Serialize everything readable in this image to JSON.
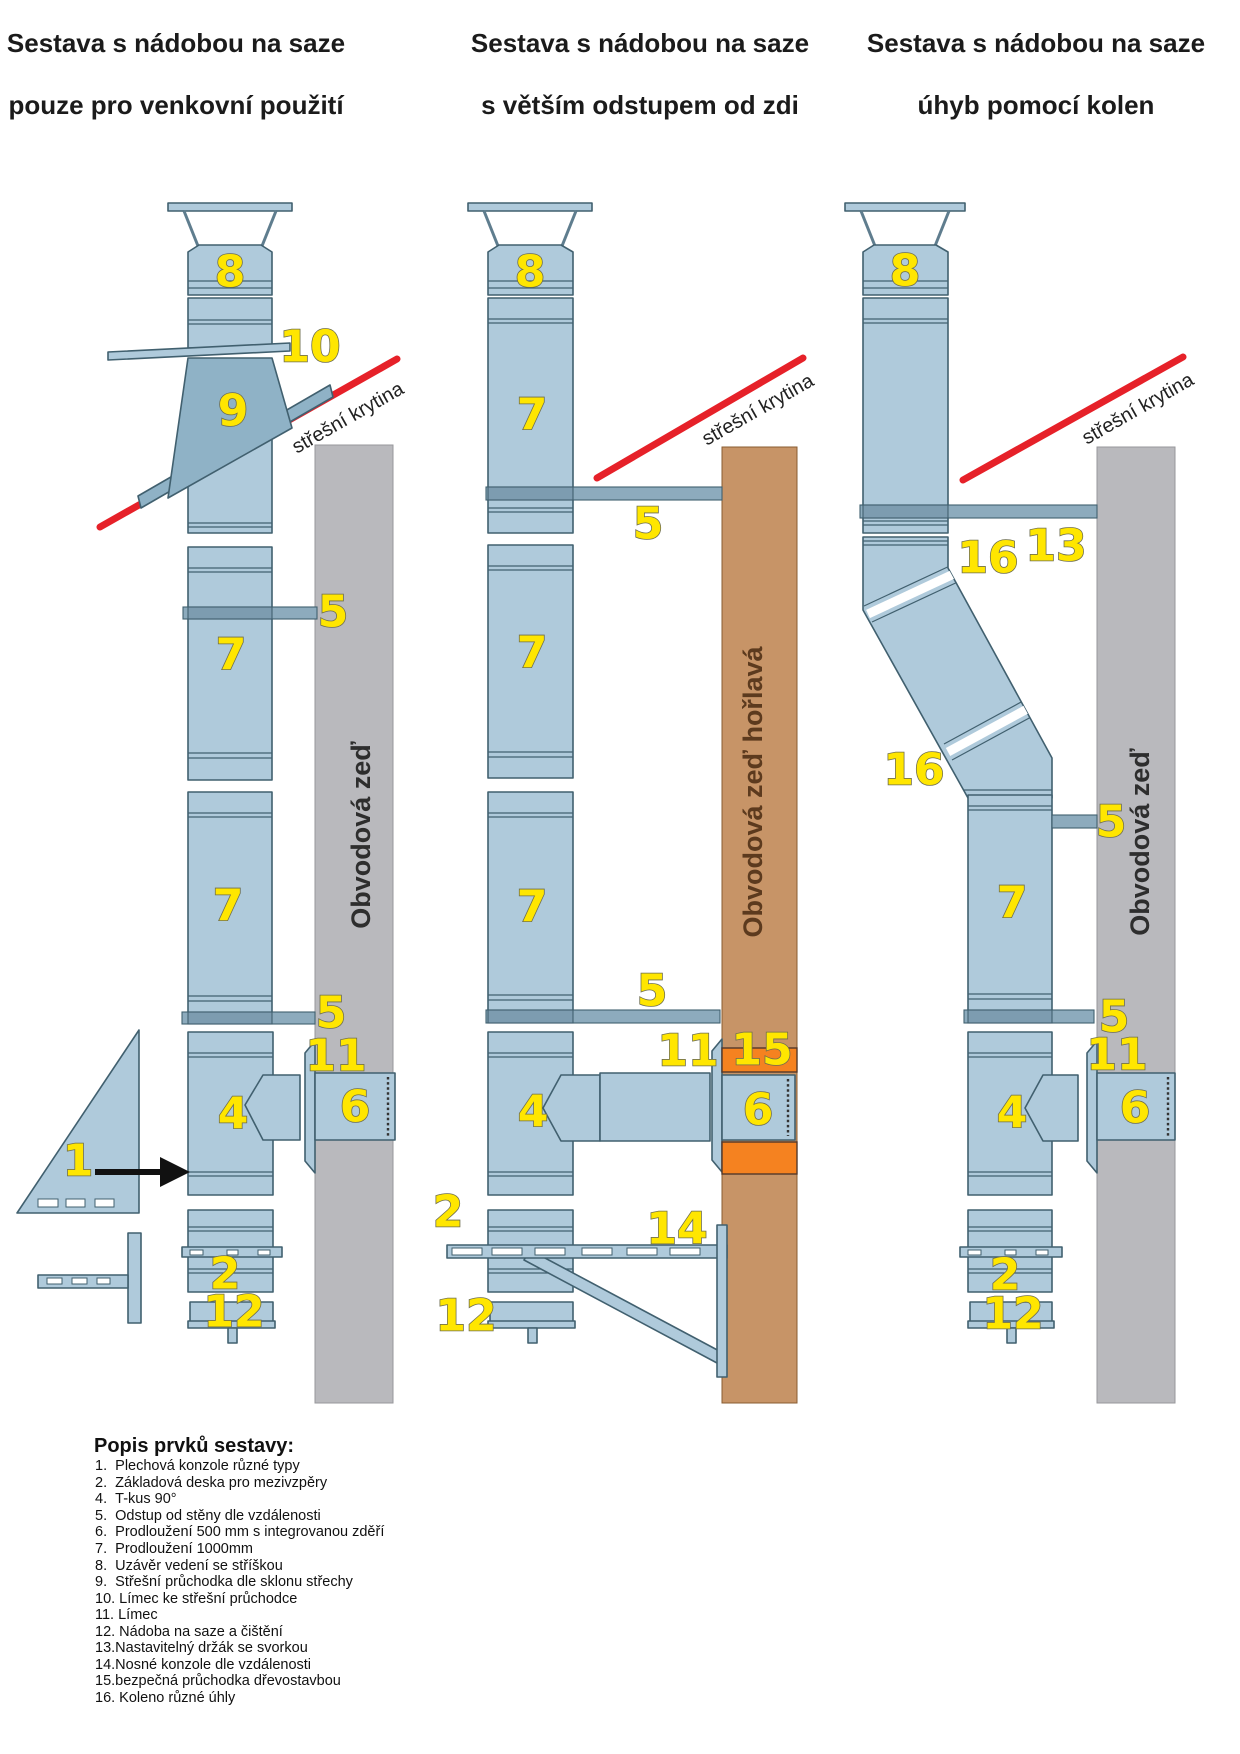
{
  "colors": {
    "pipe": "#afcadb",
    "pipe_stroke": "#41606f",
    "flash": "#8fb2c6",
    "bar": "#8dabbd",
    "bar_dark": "#7d9cb0",
    "wall_gray": "#b9b9bd",
    "wall_gray_stroke": "#97979b",
    "wall_tan": "#c79467",
    "wall_tan_stroke": "#8a5c32",
    "orange": "#f58220",
    "red": "#e62129",
    "yellow": "#ffe600",
    "num_stroke": "#6d6d50",
    "title": "#1b1b1b",
    "roof_text": "#222222",
    "wall_text": "#2e2e2e",
    "wall_text_tan": "#5c3a1e",
    "steel": "#5f7d8e"
  },
  "titles": [
    {
      "line1": "Sestava s nádobou na saze",
      "line2": "pouze pro venkovní použití"
    },
    {
      "line1": "Sestava s nádobou na saze",
      "line2": "s větším odstupem od zdi"
    },
    {
      "line1": "Sestava s nádobou na saze",
      "line2": "úhyb pomocí kolen"
    }
  ],
  "annotations": {
    "roof_covering": "střešní krytina",
    "perimeter_wall": "Obvodová zeď",
    "perimeter_wall_flammable": "Obvodová zeď hořlavá"
  },
  "labels": {
    "l1": "1",
    "l2": "2",
    "l4": "4",
    "l5": "5",
    "l6": "6",
    "l7": "7",
    "l8": "8",
    "l9": "9",
    "l10": "10",
    "l11": "11",
    "l12": "12",
    "l13": "13",
    "l14": "14",
    "l15": "15",
    "l16": "16"
  },
  "legend": {
    "heading": "Popis prvků sestavy:",
    "items": [
      "1.  Plechová konzole různé typy",
      "2.  Základová deska pro mezivzpěry",
      "4.  T-kus 90°",
      "5.  Odstup od stěny dle vzdálenosti",
      "6.  Prodloužení 500 mm s integrovanou zděří",
      "7.  Prodloužení 1000mm",
      "8.  Uzávěr vedení se stříškou",
      "9.  Střešní průchodka dle sklonu střechy",
      "10. Límec ke střešní průchodce",
      "11. Límec",
      "12. Nádoba na saze a čištění",
      "13.Nastavitelný držák se svorkou",
      "14.Nosné konzole dle vzdálenosti",
      "15.bezpečná průchodka dřevostavbou",
      "16. Koleno různé úhly"
    ]
  }
}
